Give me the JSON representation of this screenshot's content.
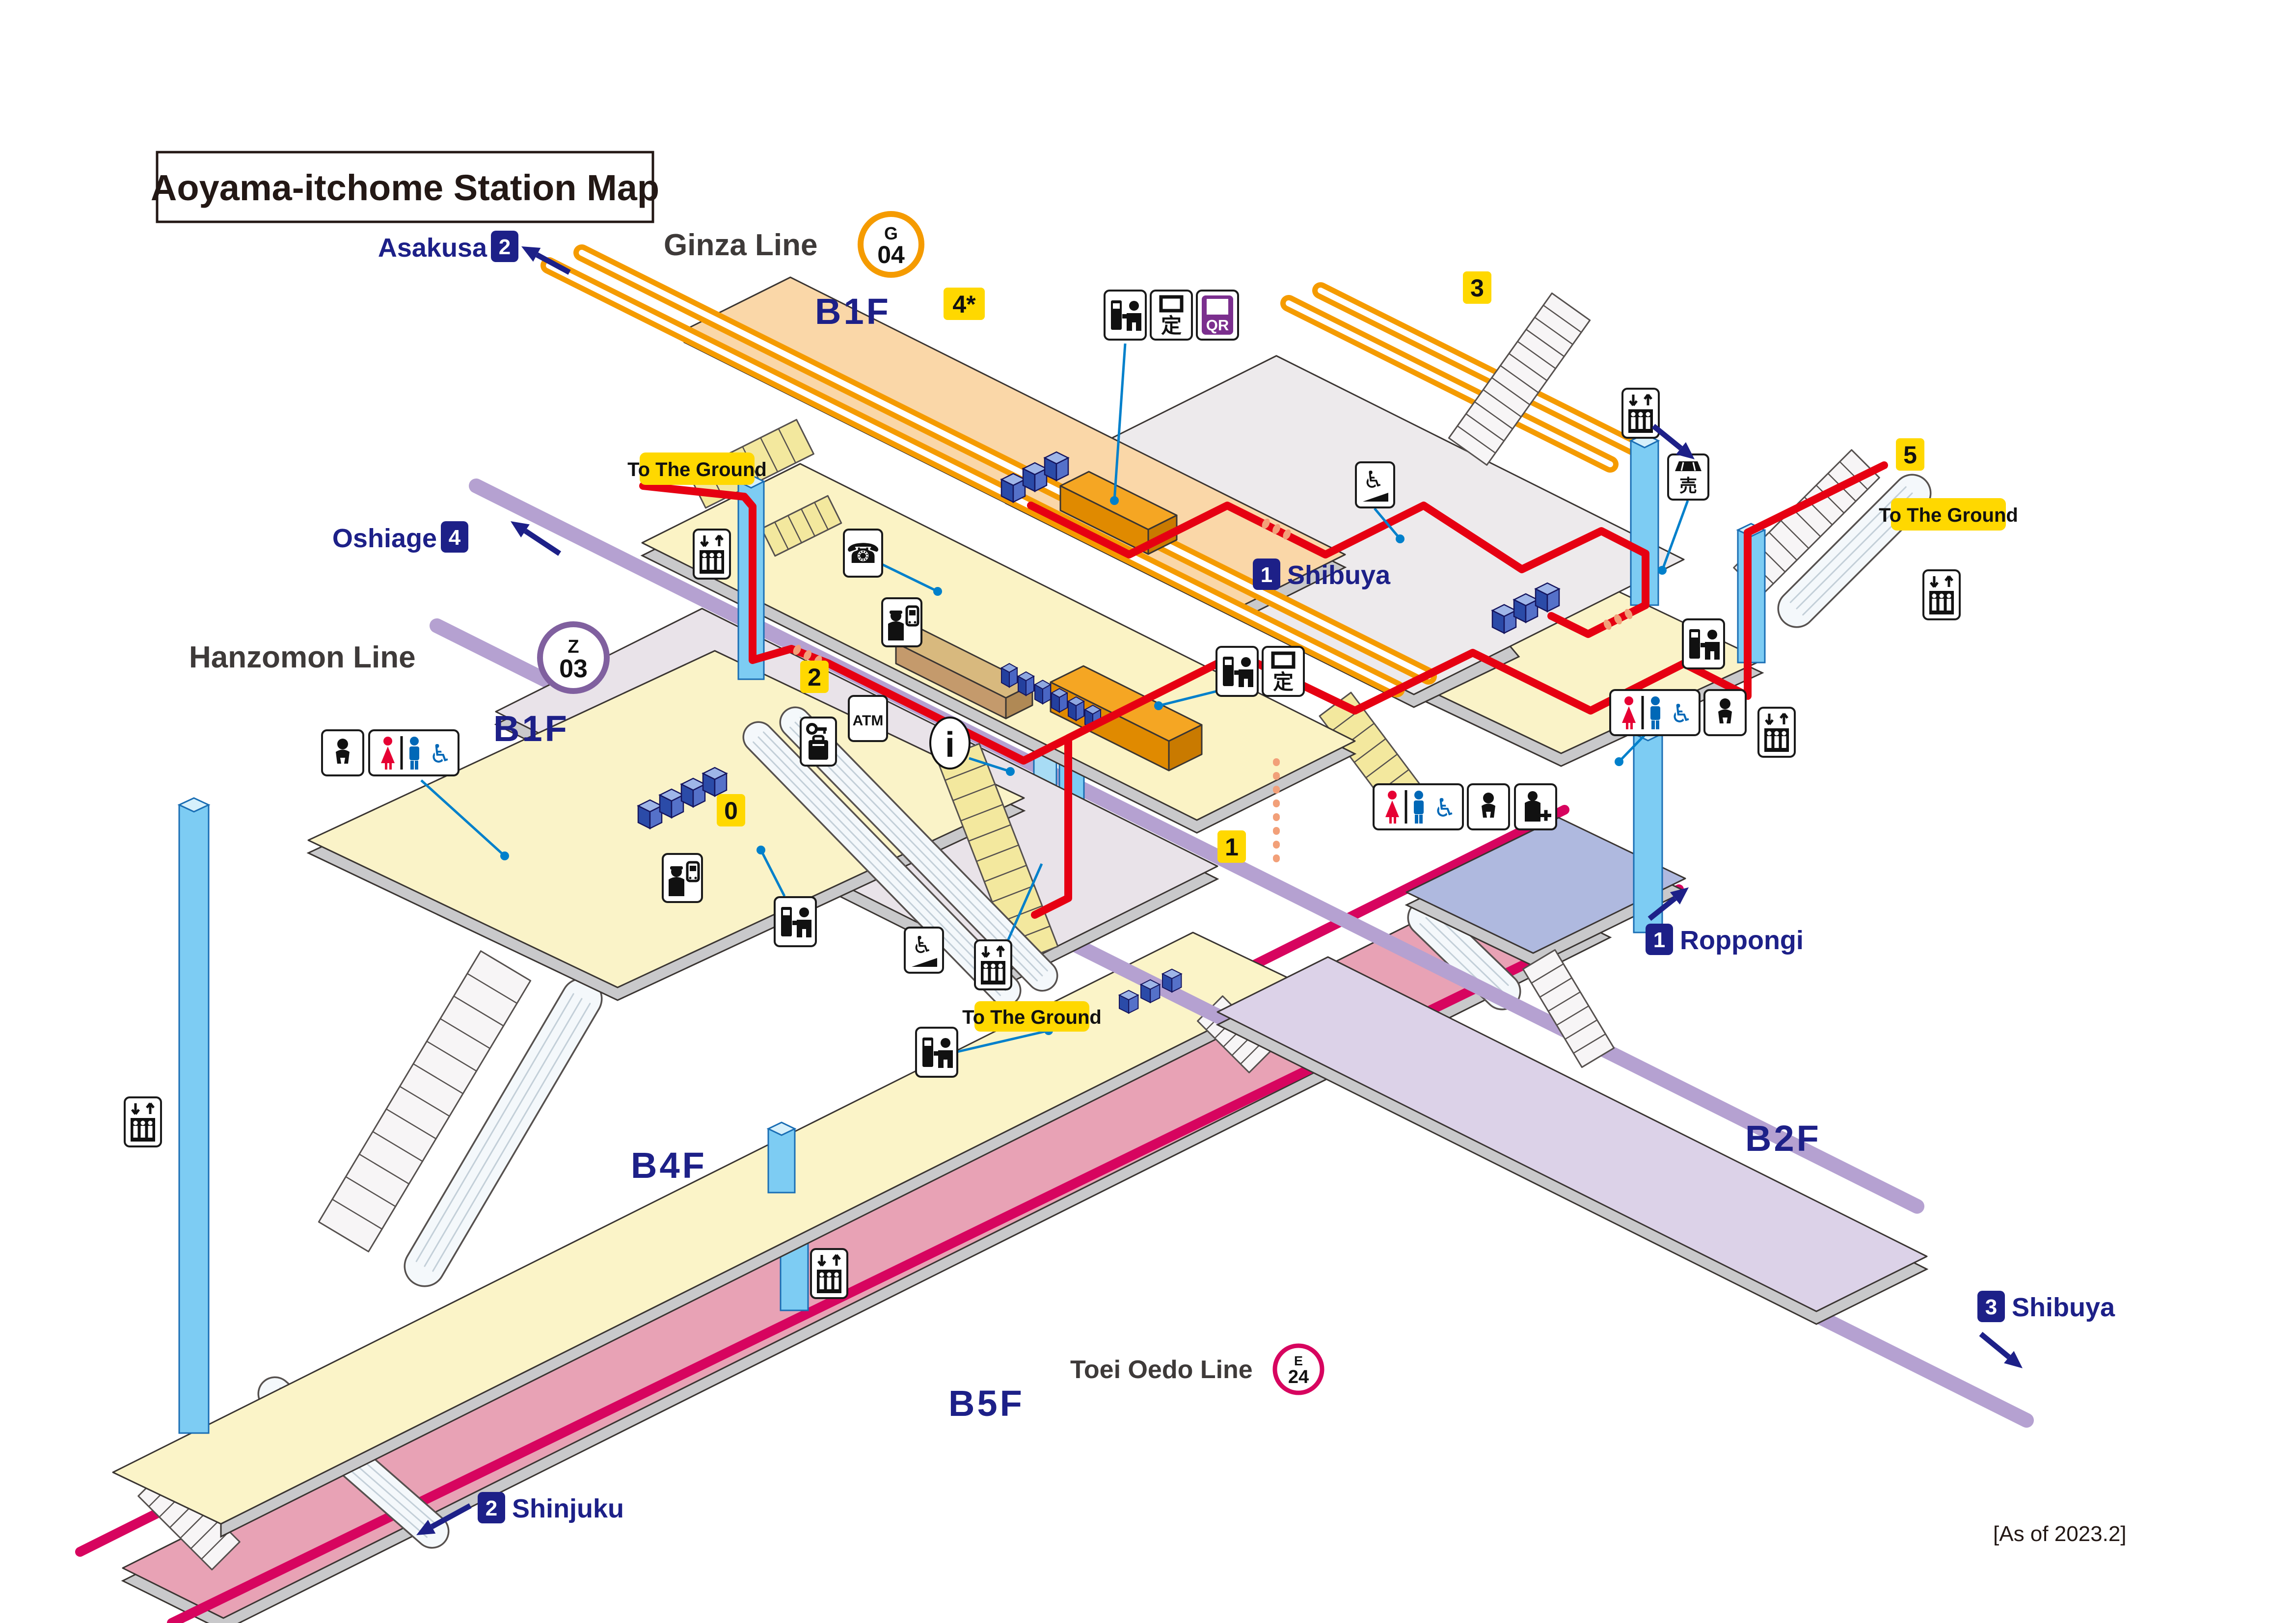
{
  "title": "Aoyama-itchome Station Map",
  "footer": "[As of 2023.2]",
  "lines": {
    "ginza": {
      "name": "Ginza Line",
      "code_letter": "G",
      "code_number": "04",
      "color": "#F59B00"
    },
    "hanzomon": {
      "name": "Hanzomon Line",
      "code_letter": "Z",
      "code_number": "03",
      "color": "#80609F"
    },
    "oedo": {
      "name": "Toei Oedo Line",
      "code_letter": "E",
      "code_number": "24",
      "color": "#D7045F"
    }
  },
  "floors": {
    "ginza_b1f": "B1F",
    "concourse_b1f": "B1F",
    "b2f": "B2F",
    "b4f": "B4F",
    "b5f": "B5F"
  },
  "exits": {
    "e0": "0",
    "e1": "1",
    "e2": "2",
    "e3": "3",
    "e4": "4*",
    "e5": "5"
  },
  "directions": {
    "asakusa": {
      "platform": "2",
      "name": "Asakusa"
    },
    "oshiage": {
      "platform": "4",
      "name": "Oshiage"
    },
    "shibuya_ginza": {
      "platform": "1",
      "name": "Shibuya"
    },
    "roppongi": {
      "platform": "1",
      "name": "Roppongi"
    },
    "shibuya_hanzomon": {
      "platform": "3",
      "name": "Shibuya"
    },
    "shinjuku": {
      "platform": "2",
      "name": "Shinjuku"
    }
  },
  "ground_label": "To The Ground",
  "glyphs": {
    "atm": "ATM",
    "info": "i",
    "commuter_pass": "定",
    "qr": "QR",
    "kiosk": "売",
    "phone": "☎",
    "wheelchair": "♿"
  },
  "colors": {
    "route_red": "#E60012",
    "elevator_blue": "#7DCCF3",
    "exit_yellow": "#FFD800",
    "nav_blue": "#1d2088"
  }
}
